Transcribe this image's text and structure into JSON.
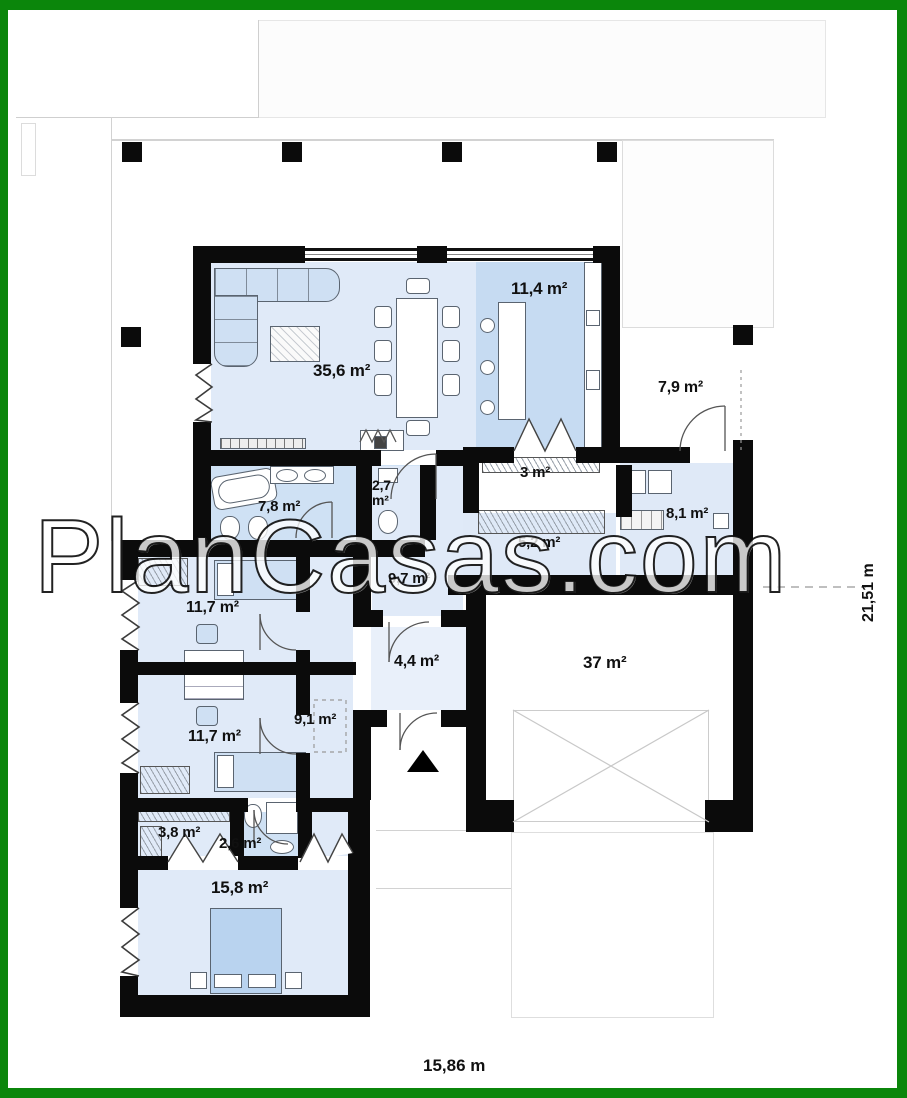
{
  "watermark_text": "PlanCasas.com",
  "rooms": {
    "living": {
      "name": "living-dining-room",
      "area": "35,6 m²"
    },
    "kitchen": {
      "name": "kitchen",
      "area": "11,4 m²"
    },
    "porch": {
      "name": "entry-porch",
      "area": "7,9 m²"
    },
    "pantry": {
      "name": "pantry",
      "area": "3 m²"
    },
    "wc": {
      "name": "wc",
      "area": "2,7 m²"
    },
    "bathroom_main": {
      "name": "bathroom",
      "area": "7,8 m²"
    },
    "utility": {
      "name": "utility-room",
      "area": "8,1 m²"
    },
    "hall": {
      "name": "hall",
      "area": "5,2 m²"
    },
    "corridor_main": {
      "name": "corridor",
      "area": "9,7 m²"
    },
    "bedroom_1": {
      "name": "bedroom-1",
      "area": "11,7 m²"
    },
    "vestibule": {
      "name": "vestibule",
      "area": "4,4 m²"
    },
    "garage": {
      "name": "garage",
      "area": "37 m²"
    },
    "corridor_night": {
      "name": "night-corridor",
      "area": "9,1 m²"
    },
    "bedroom_2": {
      "name": "bedroom-2",
      "area": "11,7 m²"
    },
    "wardrobe": {
      "name": "wardrobe",
      "area": "3,8 m²"
    },
    "bathroom_small": {
      "name": "shower-room",
      "area": "2,6 m²"
    },
    "bedroom_master": {
      "name": "master-bedroom",
      "area": "15,8 m²"
    }
  },
  "dimensions": {
    "total_width": "15,86 m",
    "total_height": "21,51 m"
  },
  "colors": {
    "frame_green": "#0b860b",
    "wall_black": "#0b0b0b",
    "room_fill_light": "#e0eaf8",
    "room_fill_accent": "#c6dbf2",
    "bath_fill": "#cfe1f4"
  }
}
